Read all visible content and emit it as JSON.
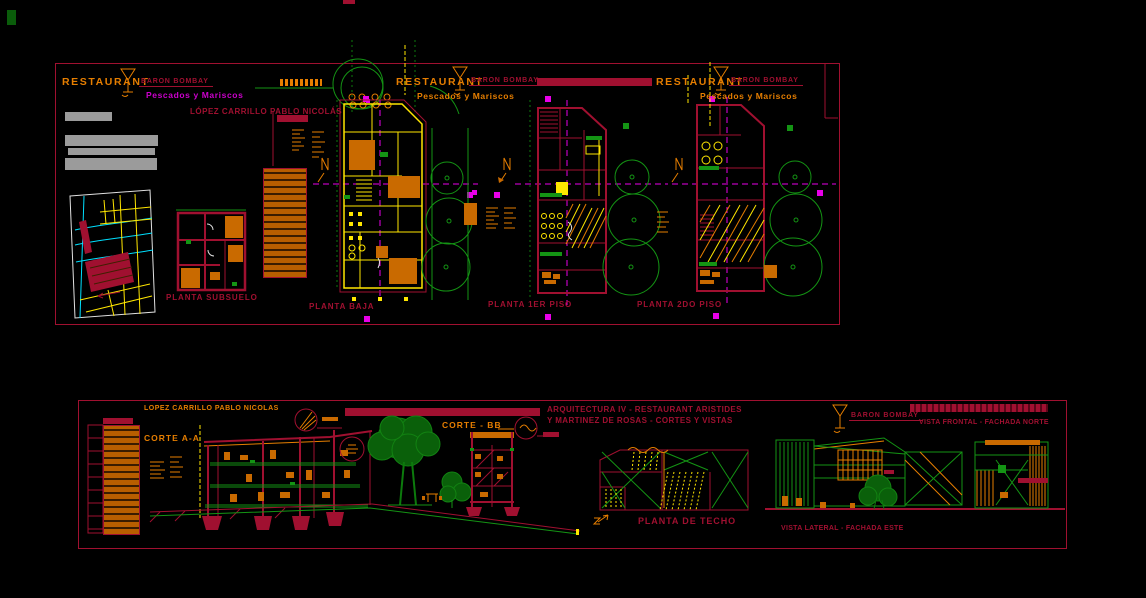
{
  "top": {
    "titles": [
      {
        "restaurant": "RESTAURANT",
        "brand": "BARON BOMBAY",
        "subtitle": "Pescados y Mariscos"
      },
      {
        "restaurant": "RESTAURANT",
        "brand": "BARON BOMBAY",
        "subtitle": "Pescados y Mariscos"
      },
      {
        "restaurant": "RESTAURANT",
        "brand": "BARON BOMBAY",
        "subtitle": "Pescados y Mariscos"
      }
    ],
    "author": "LÓPEZ CARRILLO PABLO NICOLÁS",
    "plan_labels": {
      "subsuelo": "PLANTA SUBSUELO",
      "baja": "PLANTA BAJA",
      "primer": "PLANTA 1ER PISO",
      "segundo": "PLANTA 2DO PISO"
    }
  },
  "bottom": {
    "author": "LOPEZ CARRILLO PABLO NICOLAS",
    "corte_aa": "CORTE A-A",
    "corte_bb": "CORTE - BB",
    "sheet_title_line1": "ARQUITECTURA IV - RESTAURANT ARISTIDES",
    "sheet_title_line2": "Y MARTINEZ DE ROSAS - CORTES Y VISTAS",
    "brand": "BARON BOMBAY",
    "planta_techo": "PLANTA DE TECHO",
    "vista_frontal": "VISTA FRONTAL - FACHADA NORTE",
    "vista_lateral": "VISTA LATERAL - FACHADA ESTE"
  },
  "colors": {
    "crimson": "#a01030",
    "orange": "#e67e00",
    "yellow": "#ffe600",
    "green": "#149414",
    "magenta": "#e800e8",
    "cyan": "#00e0ff"
  }
}
